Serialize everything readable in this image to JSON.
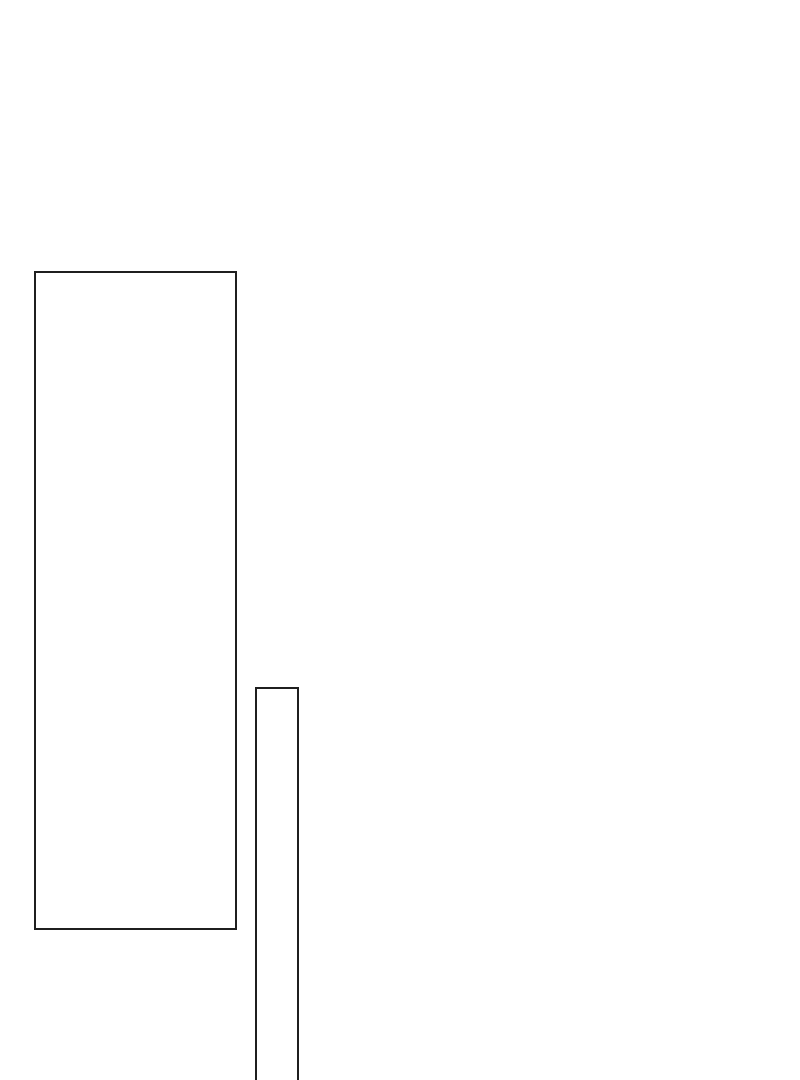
{
  "canvas": {
    "background": "#ffffff",
    "width": 800,
    "height": 1080
  },
  "shapes": [
    {
      "id": "large-rectangle",
      "type": "rect",
      "x": 34,
      "y": 271,
      "width": 203,
      "height": 659,
      "stroke": "#1f1f1f",
      "stroke_width": 2,
      "fill": "none"
    },
    {
      "id": "narrow-rectangle",
      "type": "rect",
      "x": 255,
      "y": 687,
      "width": 44,
      "height": 430,
      "stroke": "#1f1f1f",
      "stroke_width": 2,
      "fill": "none"
    }
  ]
}
